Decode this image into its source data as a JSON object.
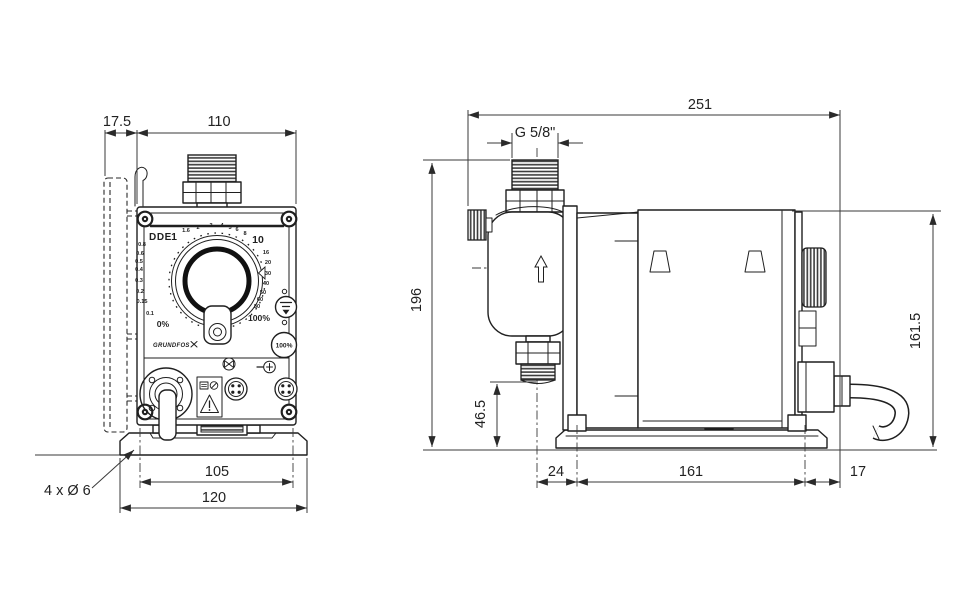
{
  "colors": {
    "background": "#ffffff",
    "line": "#1f1f1f",
    "dimension": "#3a3a3a"
  },
  "front_view": {
    "model": "DDE",
    "brand": "GRUNDFOS",
    "button_100": "100%",
    "dial_scale": [
      "0%",
      "0.1",
      "0.15",
      "0.2",
      "0.3",
      "0.4",
      "0.5",
      "0.6",
      "0.8",
      "1",
      "1.6",
      "2",
      "3",
      "4",
      "5",
      "6",
      "8",
      "10",
      "16",
      "20",
      "30",
      "40",
      "50",
      "60",
      "80",
      "100%"
    ],
    "dims": {
      "bracket_depth": "17.5",
      "housing_width": "110",
      "mount_hole_pitch": "105",
      "base_width": "120",
      "mount_holes_note": "4 x Ø 6"
    }
  },
  "side_view": {
    "dims": {
      "total_length": "251",
      "connection_thread": "G 5/8\"",
      "total_height": "196",
      "housing_height": "161.5",
      "connection_height": "46.5",
      "front_offset": "24",
      "mount_hole_pitch": "161",
      "rear_offset": "17"
    }
  },
  "icons": [
    "grundfos-logo",
    "priming-button-icon",
    "flow-direction-arrow",
    "warning-triangle-icon",
    "relief-valve-icon",
    "plug-icon",
    "drain-flange",
    "signal-connector",
    "signal-connector-2",
    "panel-screw",
    "dial-knob"
  ]
}
